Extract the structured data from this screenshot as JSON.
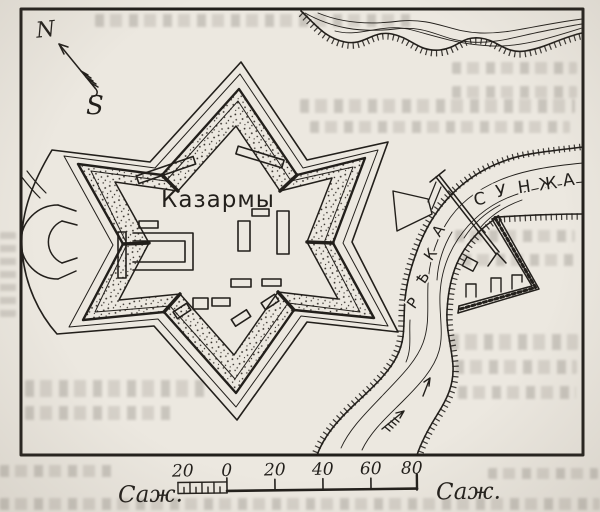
{
  "colors": {
    "paper": "#ece8e0",
    "ink": "#221f1b"
  },
  "compass": {
    "north_label": "N",
    "south_label": "S"
  },
  "fort": {
    "barracks_label": "Казармы"
  },
  "river": {
    "vertical_word": "РѢКА",
    "horizontal_word": "СУНЖА",
    "vertical_letters": [
      "Р",
      "Ѣ",
      "К",
      "А"
    ],
    "horizontal_letters": [
      "С",
      "У",
      "Н",
      "Ж",
      "А"
    ]
  },
  "scale_bar": {
    "unit_label_left": "Саж.",
    "unit_label_right": "Саж.",
    "tick_labels": [
      "20",
      "0",
      "20",
      "40",
      "60",
      "80"
    ]
  }
}
